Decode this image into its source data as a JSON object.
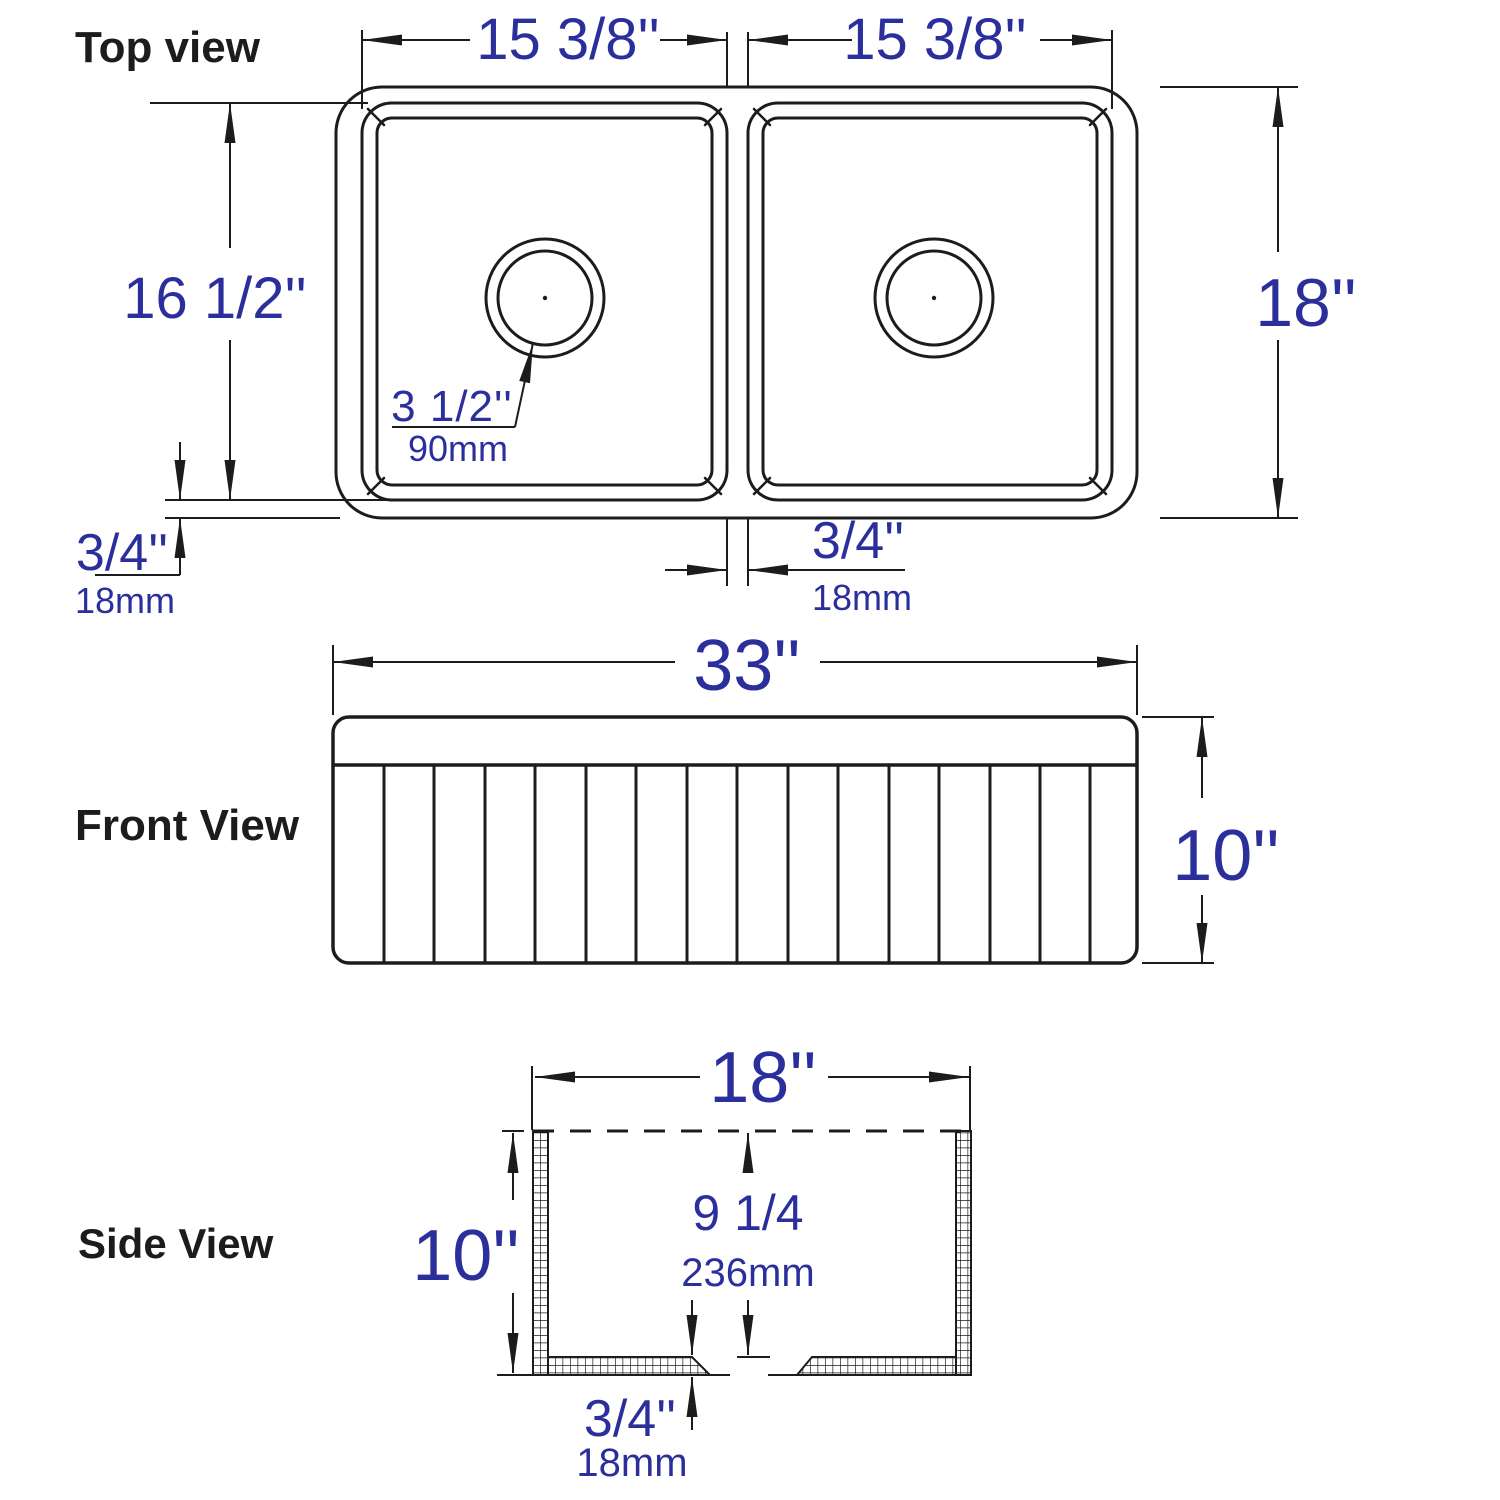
{
  "colors": {
    "linework": "#1c1c1c",
    "dimension_text": "#2b2f9b",
    "background": "#ffffff"
  },
  "top_view": {
    "label": "Top view",
    "left_bowl_width": "15 3/8''",
    "right_bowl_width": "15 3/8''",
    "overall_depth": "18''",
    "bowl_depth": "16 1/2''",
    "drain_diameter": "3 1/2''",
    "drain_diameter_mm": "90mm",
    "rim_thickness": "3/4''",
    "rim_thickness_mm": "18mm",
    "divider_thickness": "3/4''",
    "divider_thickness_mm": "18mm"
  },
  "front_view": {
    "label": "Front View",
    "overall_width": "33''",
    "apron_height": "10''"
  },
  "side_view": {
    "label": "Side View",
    "overall_depth": "18''",
    "overall_height": "10''",
    "bowl_inner_depth": "9 1/4",
    "bowl_inner_depth_mm": "236mm",
    "base_thickness": "3/4''",
    "base_thickness_mm": "18mm"
  }
}
